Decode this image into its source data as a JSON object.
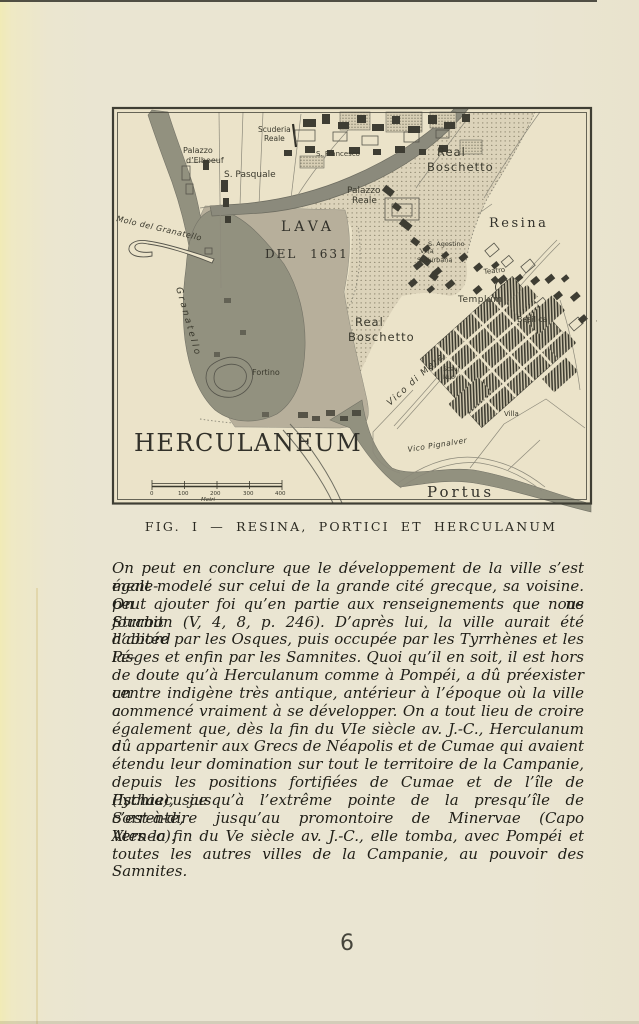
{
  "page": {
    "number": "6"
  },
  "figure": {
    "caption": "FIG. I — RESINA, PORTICI ET HERCULANUM",
    "labels": {
      "scuderia_reale": [
        "Scuderia",
        "Reale"
      ],
      "palazzo_elboeuf": [
        "Palazzo",
        "d’Elboeuf"
      ],
      "s_pasquale": "S. Pasquale",
      "s_francesco": "S. Francesco",
      "real_boschetto_upper": [
        "Real",
        "Boschetto"
      ],
      "palazzo_reale": [
        "Palazzo",
        "Reale"
      ],
      "resina": "Resina",
      "lava": [
        "LAVA",
        "DEL 1631"
      ],
      "molo_del_granatello": "Molo del Granatello",
      "granatello": "Granatello",
      "fortino": "Fortino",
      "real_boschetto_lower": [
        "Real",
        "Boschetto"
      ],
      "herculaneum": "HERCULANEUM",
      "vico_di_mare": "Vico di Mare",
      "scavi_nuovi": [
        "Scavi",
        "Nuovi"
      ],
      "villa": "Villa",
      "templum": "Templum",
      "basilica": "Basilica",
      "teatro": "Teatro",
      "s_agostino": "S. Agostino",
      "villa_suburbana": [
        "Villa",
        "Suburbana"
      ],
      "vico_pignalver": "Vico Pignalver",
      "portus": "Portus"
    },
    "scale_bar": {
      "ticks": [
        "0",
        "100",
        "200",
        "300",
        "400"
      ],
      "unit": "Metri"
    }
  },
  "body": {
    "lines": [
      "On peut en conclure que le développement de la ville s’est égale-",
      "ment modelé sur celui de la grande cité grecque, sa voisine. On ne",
      "peut ajouter foi qu’en partie aux renseignements que nous fournit",
      "Strabon (V, 4, 8, p. 246). D’après lui, la ville aurait été d’abord",
      "habitée par les Osques, puis occupée par les Tyrrhènes et les Pé-",
      "lasges et enfin par les Samnites. Quoi qu’il en soit, il est hors",
      "de doute qu’à Herculanum comme à Pompéi, a dû préexister un",
      "centre indigène très antique, antérieur à l’époque où la ville a",
      "commencé vraiment à se développer. On a tout lieu de croire",
      "également que, dès la fin du VIe siècle av. J.-C., Herculanum a",
      "dû appartenir aux Grecs de Néapolis et de Cumae qui avaient",
      "étendu leur domination sur tout le territoire de la Campanie,",
      "depuis les positions fortifiées de Cumae et de l’île de Pythaecusae",
      "(Ischia), jusqu’à l’extrême pointe de la presqu’île de Sorrente,",
      "c’est-à-dire jusqu’au promontoire de Minervae (Capo Ateneo).",
      "Vers la fin du Ve siècle av. J.-C., elle tomba, avec Pompéi et",
      "toutes les autres villes de la Campanie, au pouvoir des Samnites."
    ]
  },
  "colors": {
    "page_cream": "#eae5d2",
    "gutter_yellow": "#f1ebb6",
    "map_cream": "#ebe3c9",
    "lava_dark": "#92917f",
    "lava_medium": "#b7af9b",
    "stipple": "#dcd3ba",
    "ink": "#3a392d"
  }
}
